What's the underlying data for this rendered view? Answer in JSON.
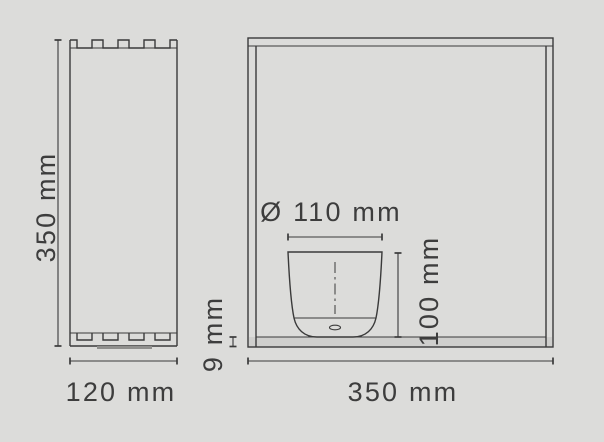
{
  "colors": {
    "background": "#dcdcda",
    "line": "#3a3a3a",
    "text": "#3d3d3d",
    "panel_fill": "#cfcfcd",
    "base_strip": "#8f8f8d"
  },
  "side_view": {
    "height_label": "350 mm",
    "width_label": "120 mm"
  },
  "front_view": {
    "width_label": "350 mm",
    "base_thickness_label": "9 mm",
    "inner_object": {
      "diameter_label": "Ø 110 mm",
      "height_label": "100 mm"
    }
  }
}
